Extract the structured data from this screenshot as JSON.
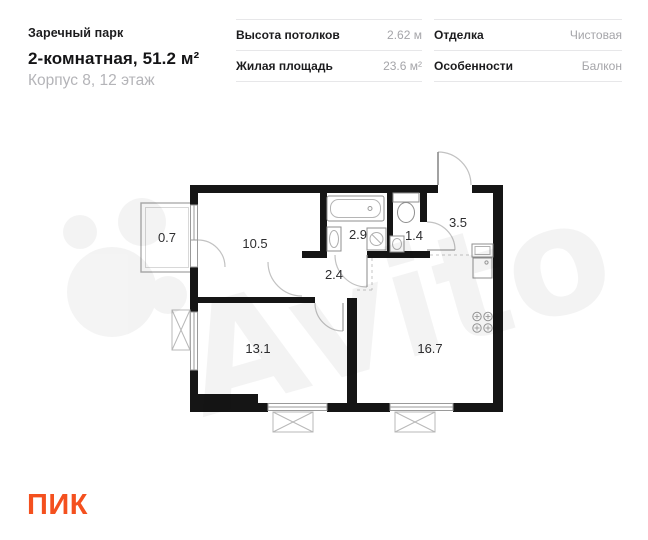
{
  "header": {
    "project": "Заречный парк",
    "title": "2-комнатная, 51.2 м²",
    "subtitle": "Корпус 8, 12 этаж"
  },
  "specs": [
    {
      "label": "Высота потолков",
      "value": "2.62 м"
    },
    {
      "label": "Жилая площадь",
      "value": "23.6 м²"
    },
    {
      "label": "Отделка",
      "value": "Чистовая"
    },
    {
      "label": "Особенности",
      "value": "Балкон"
    }
  ],
  "floorplan": {
    "room_areas": {
      "balcony": "0.7",
      "living_room": "10.5",
      "bathroom": "2.9",
      "wc": "1.4",
      "hallway": "3.5",
      "corridor": "2.4",
      "bedroom": "13.1",
      "kitchen_living": "16.7"
    }
  },
  "watermark": "Avito",
  "brand": {
    "name": "ПИК",
    "color": "#F4501E"
  }
}
